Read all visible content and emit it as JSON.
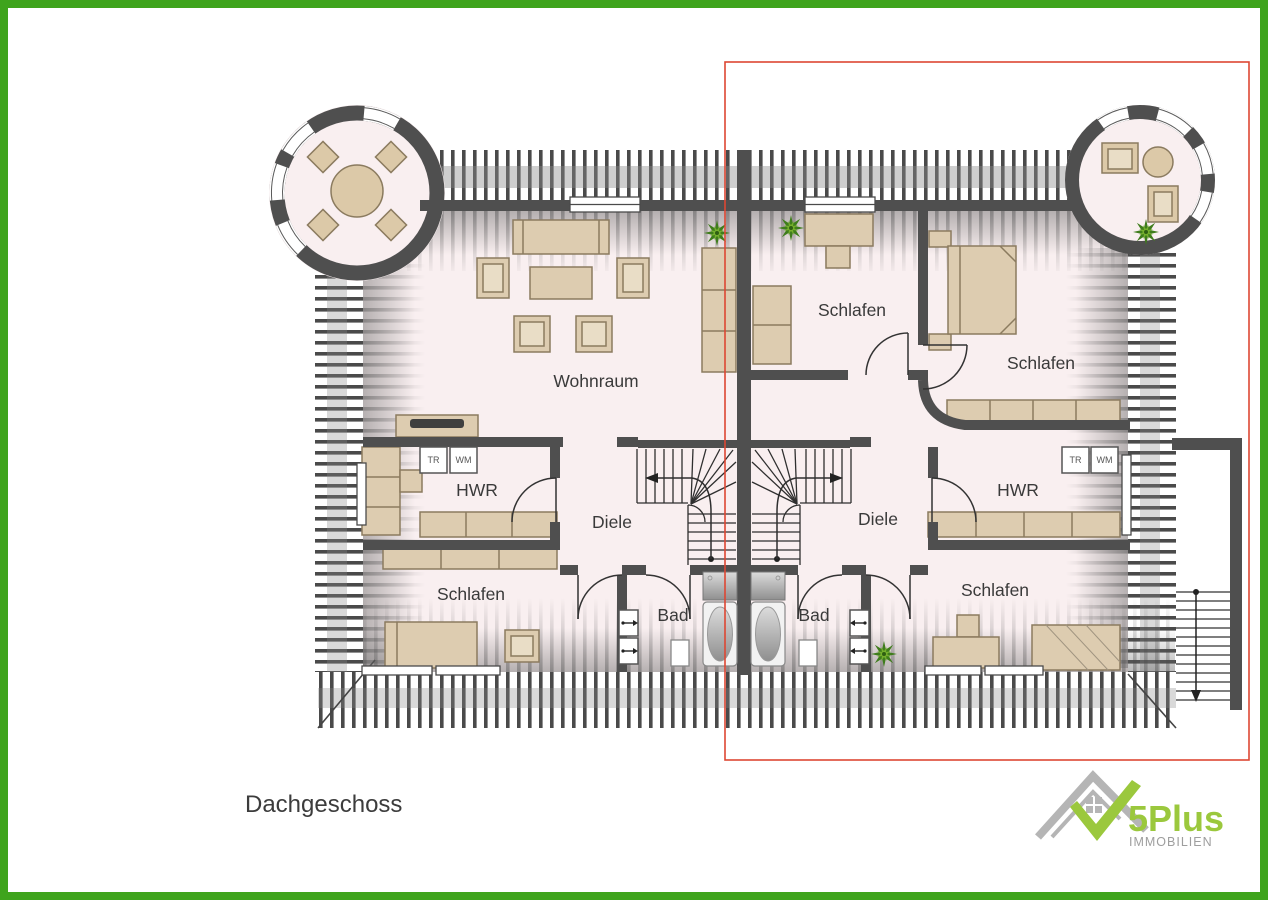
{
  "title": {
    "floor_label": "Dachgeschoss"
  },
  "rooms": {
    "wohnraum": "Wohnraum",
    "schlafen_top_middle": "Schlafen",
    "schlafen_top_right": "Schlafen",
    "schlafen_bottom_left": "Schlafen",
    "schlafen_bottom_right": "Schlafen",
    "hwr_left": "HWR",
    "hwr_right": "HWR",
    "diele_left": "Diele",
    "diele_right": "Diele",
    "bad_left": "Bad",
    "bad_right": "Bad"
  },
  "appliances": {
    "dryer": "TR",
    "washer": "WM"
  },
  "logo": {
    "brand": "5Plus",
    "subtitle": "IMMOBILIEN"
  },
  "colors": {
    "frame_green": "#3fa41d",
    "selection_red": "#dd4733",
    "wall_gray": "#4f4f4f",
    "floor_pink": "#f9eff0",
    "furniture_tan": "#ddccb0",
    "logo_green": "#9bc83d",
    "logo_gray": "#b5b5b5",
    "label_gray": "#3a3a3a"
  }
}
